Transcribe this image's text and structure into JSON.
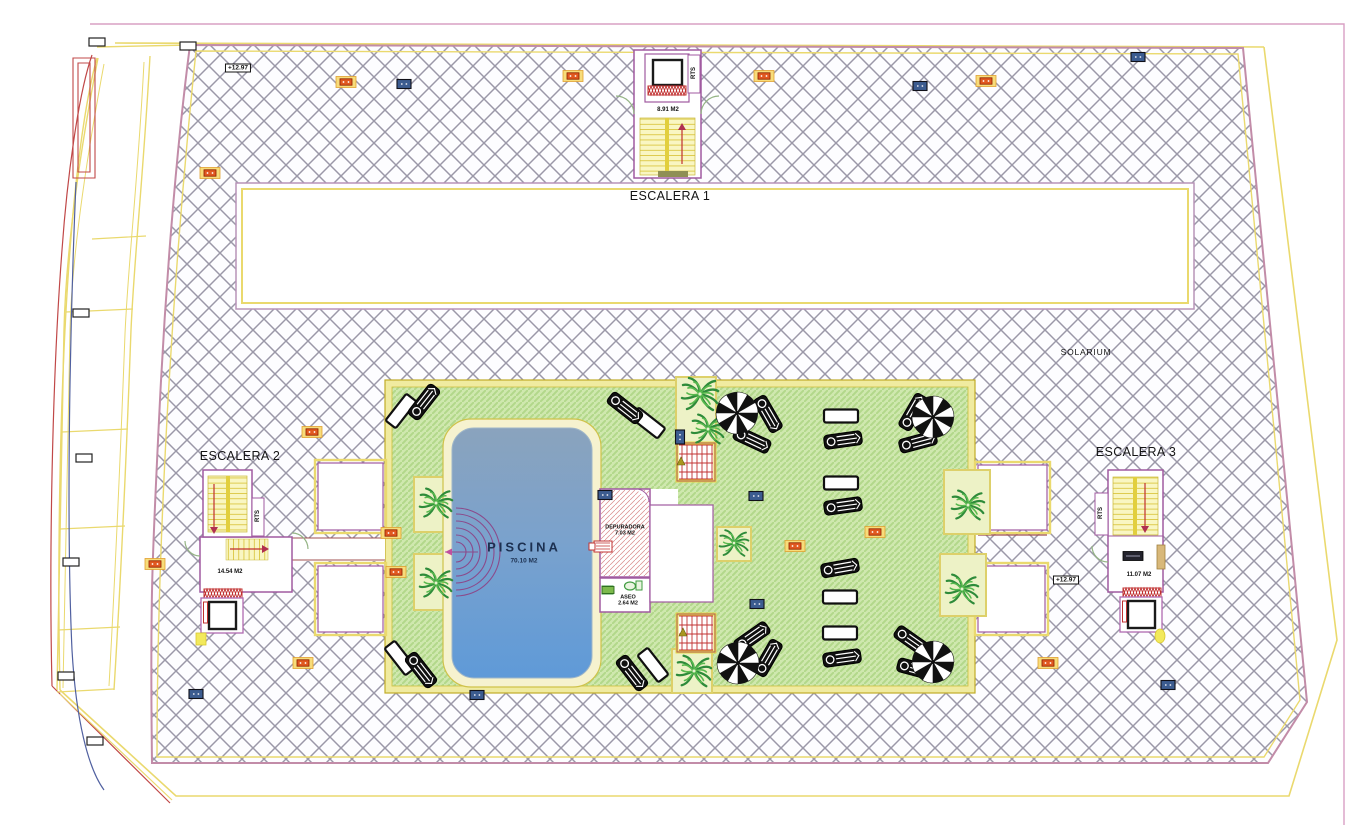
{
  "labels": {
    "escalera1": "ESCALERA 1",
    "escalera1_area": "8.91 M2",
    "escalera2": "ESCALERA 2",
    "escalera2_area": "14.54 M2",
    "escalera3": "ESCALERA 3",
    "escalera3_area": "11.07 M2",
    "solarium": "SOLARIUM",
    "piscina": "PISCINA",
    "piscina_area": "70.10 M2",
    "depuradora": "DEPURADORA",
    "depuradora_area": "7.03 M2",
    "aseo": "ASEO",
    "aseo_area": "2.64 M2",
    "rts": "RTS",
    "elevation": "+12.97"
  },
  "colors": {
    "hatch_line": "#9b98a8",
    "boundary_pink": "#c28ca8",
    "yellow_border": "#ead96e",
    "green_deck": "#cfe8ae",
    "green_stripe": "#b2d88a",
    "pool_top": "#8aa3bd",
    "pool_bottom": "#5f9ad8",
    "room_purple": "#a05aa0",
    "cad_red": "#c03030",
    "stair_yellow": "#f9f6c2"
  },
  "markers": [
    {
      "type": "white",
      "x": 97,
      "y": 42
    },
    {
      "type": "white",
      "x": 188,
      "y": 46
    },
    {
      "type": "white",
      "x": 81,
      "y": 313
    },
    {
      "type": "white",
      "x": 84,
      "y": 458
    },
    {
      "type": "white",
      "x": 71,
      "y": 562
    },
    {
      "type": "white",
      "x": 66,
      "y": 676
    },
    {
      "type": "white",
      "x": 95,
      "y": 741
    },
    {
      "type": "orange",
      "x": 346,
      "y": 82
    },
    {
      "type": "orange",
      "x": 573,
      "y": 76
    },
    {
      "type": "orange",
      "x": 764,
      "y": 76
    },
    {
      "type": "orange",
      "x": 986,
      "y": 81
    },
    {
      "type": "orange",
      "x": 210,
      "y": 173
    },
    {
      "type": "orange",
      "x": 312,
      "y": 432
    },
    {
      "type": "orange",
      "x": 391,
      "y": 533
    },
    {
      "type": "orange",
      "x": 396,
      "y": 572
    },
    {
      "type": "orange",
      "x": 155,
      "y": 564
    },
    {
      "type": "orange",
      "x": 303,
      "y": 663
    },
    {
      "type": "orange",
      "x": 1048,
      "y": 663
    },
    {
      "type": "orange",
      "x": 795,
      "y": 546
    },
    {
      "type": "orange",
      "x": 875,
      "y": 532
    },
    {
      "type": "blue",
      "x": 404,
      "y": 84
    },
    {
      "type": "blue",
      "x": 920,
      "y": 86
    },
    {
      "type": "blue",
      "x": 1138,
      "y": 57
    },
    {
      "type": "blue",
      "x": 196,
      "y": 694
    },
    {
      "type": "blue",
      "x": 477,
      "y": 695
    },
    {
      "type": "blue",
      "x": 1168,
      "y": 685
    },
    {
      "type": "blue",
      "x": 756,
      "y": 496
    },
    {
      "type": "blue",
      "x": 757,
      "y": 604
    },
    {
      "type": "blue",
      "x": 605,
      "y": 495
    },
    {
      "type": "blue",
      "x": 680,
      "y": 437,
      "rot": 90
    },
    {
      "type": "green",
      "x": 608,
      "y": 590
    },
    {
      "type": "dark",
      "x": 1133,
      "y": 556
    },
    {
      "type": "olive",
      "x": 681,
      "y": 462
    },
    {
      "type": "olive",
      "x": 683,
      "y": 633
    }
  ],
  "furniture": {
    "parasols": [
      [
        737,
        413
      ],
      [
        933,
        417
      ],
      [
        738,
        663
      ],
      [
        933,
        662
      ]
    ],
    "tables": [
      [
        401,
        411,
        -52
      ],
      [
        648,
        423,
        38
      ],
      [
        841,
        416,
        0
      ],
      [
        841,
        483,
        0
      ],
      [
        840,
        597,
        0
      ],
      [
        840,
        633,
        0
      ],
      [
        400,
        658,
        52
      ],
      [
        653,
        665,
        52
      ]
    ],
    "loungers": [
      [
        424,
        402,
        -52
      ],
      [
        625,
        408,
        38
      ],
      [
        768,
        414,
        60
      ],
      [
        752,
        440,
        25
      ],
      [
        913,
        412,
        -60
      ],
      [
        918,
        442,
        -15
      ],
      [
        843,
        440,
        -8
      ],
      [
        843,
        506,
        -8
      ],
      [
        840,
        568,
        -10
      ],
      [
        842,
        658,
        -8
      ],
      [
        421,
        670,
        52
      ],
      [
        632,
        673,
        52
      ],
      [
        752,
        637,
        -35
      ],
      [
        768,
        658,
        -60
      ],
      [
        912,
        641,
        35
      ],
      [
        916,
        669,
        15
      ]
    ],
    "palms": [
      [
        700,
        394,
        1.0
      ],
      [
        708,
        429,
        0.9
      ],
      [
        436,
        503,
        0.9
      ],
      [
        436,
        583,
        0.9
      ],
      [
        734,
        543,
        0.8
      ],
      [
        968,
        505,
        0.9
      ],
      [
        962,
        589,
        0.9
      ],
      [
        694,
        671,
        0.95
      ]
    ]
  }
}
